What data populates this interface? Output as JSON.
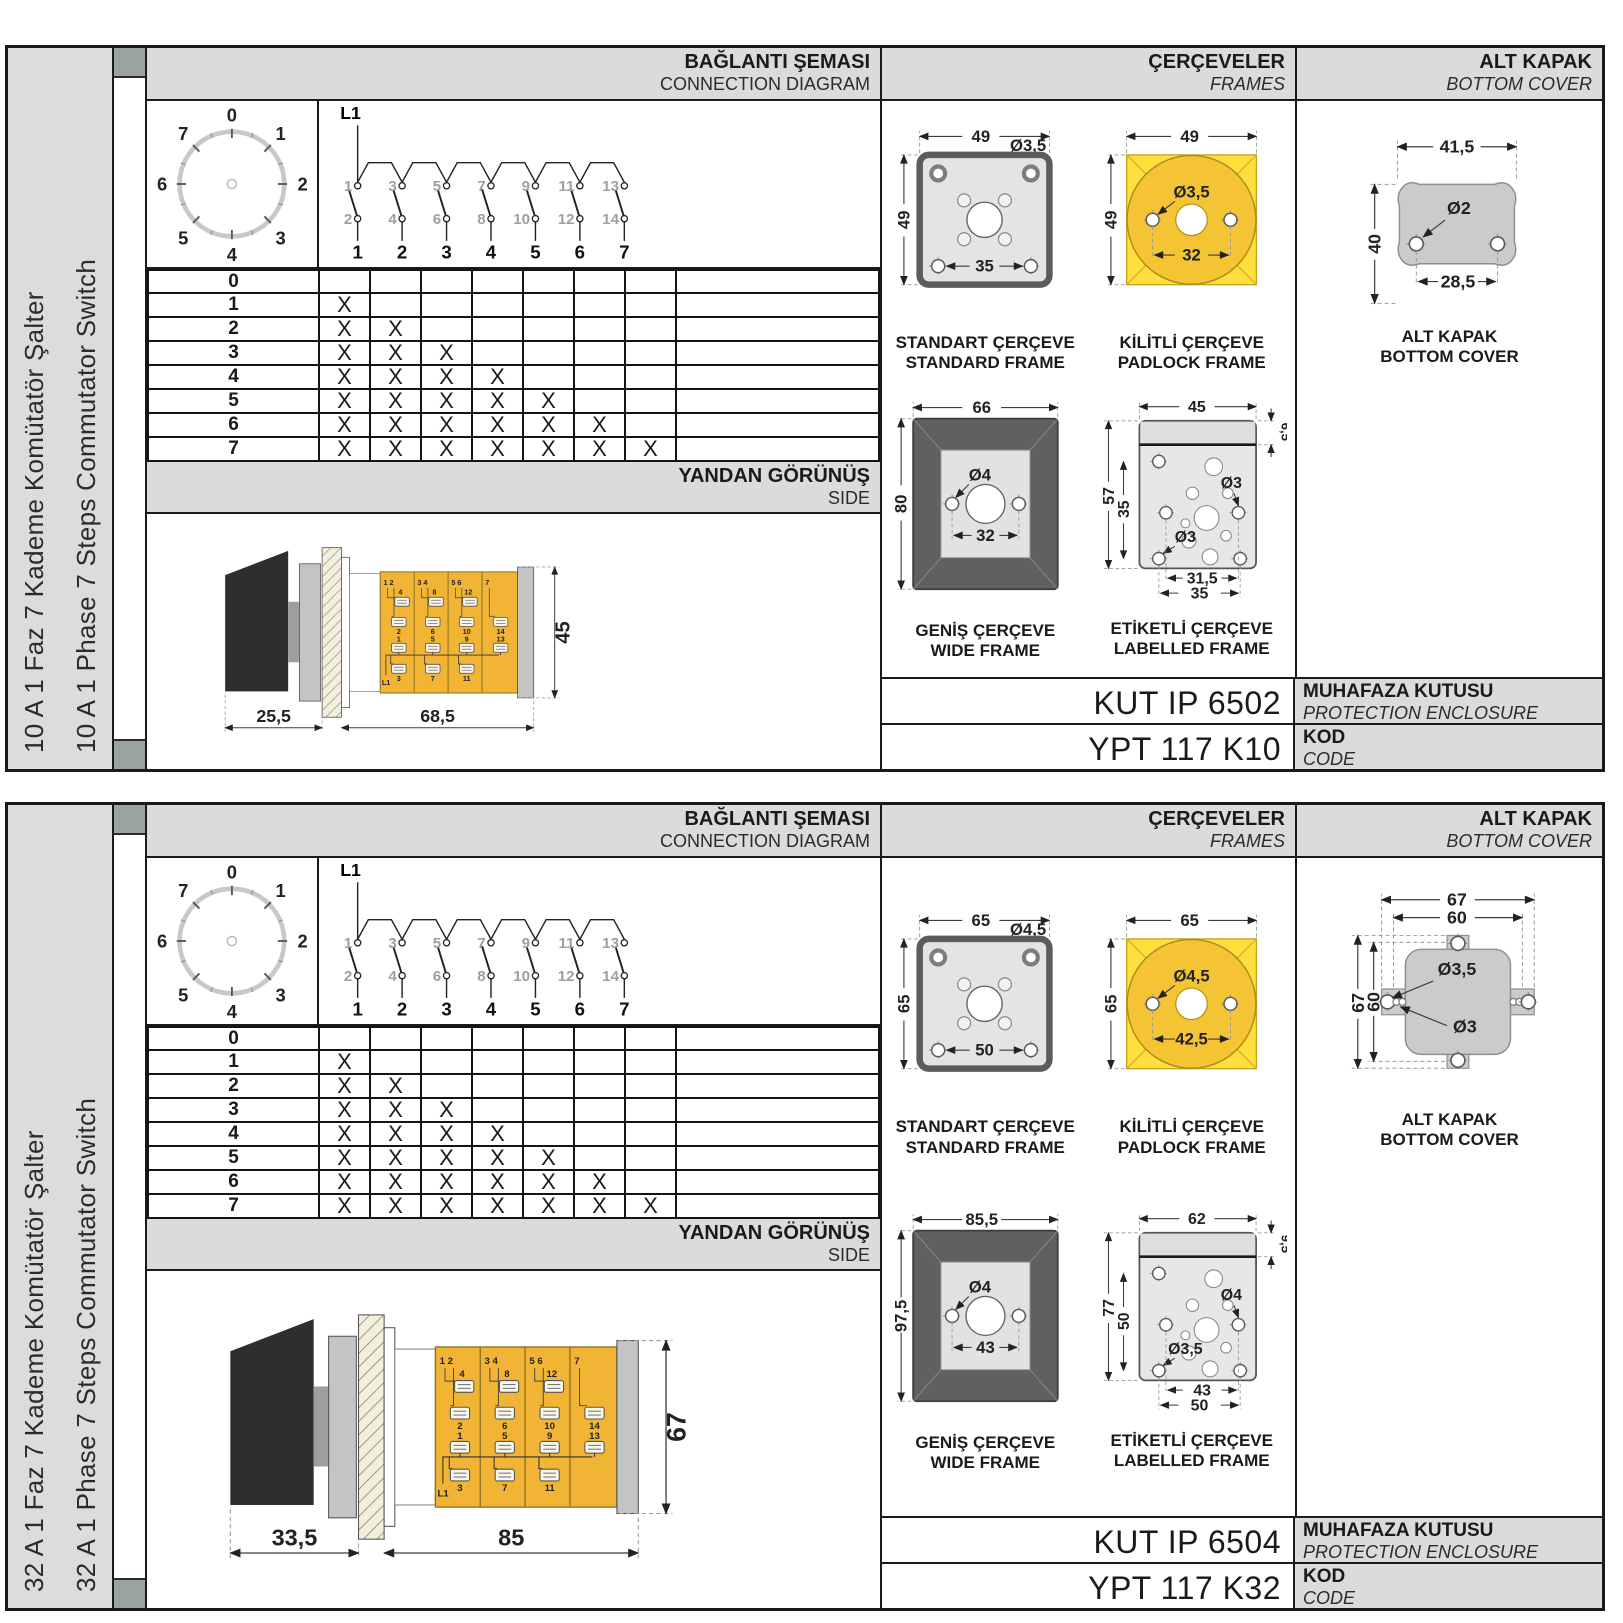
{
  "colors": {
    "body_yellow": "#f1b434",
    "padlock_yellow": "#ffdf3e",
    "padlock_circle": "#f5c434",
    "header_gray": "#dbdbdb",
    "tab_gray": "#9aa49e",
    "frame_dark": "#606060",
    "cover_gray": "#cbcbcb"
  },
  "mark_glyph": "X",
  "sections": [
    {
      "sidebar": {
        "title_tr": "10 A 1 Faz 7 Kademe Komütatör Şalter",
        "title_en": "10 A 1 Phase 7 Steps Commutator Switch"
      },
      "connection": {
        "header_tr": "BAĞLANTI ŞEMASI",
        "header_en": "CONNECTION DIAGRAM",
        "input_label": "L1",
        "dial_positions": [
          "0",
          "1",
          "2",
          "3",
          "4",
          "5",
          "6",
          "7"
        ],
        "contact_top": [
          "1",
          "3",
          "5",
          "7",
          "9",
          "11",
          "13"
        ],
        "contact_bottom": [
          "2",
          "4",
          "6",
          "8",
          "10",
          "12",
          "14"
        ],
        "outputs": [
          "1",
          "2",
          "3",
          "4",
          "5",
          "6",
          "7"
        ],
        "steps": [
          {
            "label": "0",
            "marks": 0
          },
          {
            "label": "1",
            "marks": 1
          },
          {
            "label": "2",
            "marks": 2
          },
          {
            "label": "3",
            "marks": 3
          },
          {
            "label": "4",
            "marks": 4
          },
          {
            "label": "5",
            "marks": 5
          },
          {
            "label": "6",
            "marks": 6
          },
          {
            "label": "7",
            "marks": 7
          }
        ]
      },
      "side_view": {
        "header_tr": "YANDAN GÖRÜNÜŞ",
        "header_en": "SIDE",
        "dim_front": "25,5",
        "dim_length": "68,5",
        "dim_height": "45",
        "input_label": "L1",
        "segment_top_labels": [
          "1 2",
          "3 4",
          "5 6",
          "7"
        ],
        "upper_clip_top": [
          "4",
          "8",
          "12"
        ],
        "upper_clip_bottom": [
          "2",
          "6",
          "10",
          "14"
        ],
        "lower_clip_top": [
          "1",
          "5",
          "9",
          "13"
        ],
        "lower_clip_bottom": [
          "3",
          "7",
          "11"
        ]
      },
      "frames": {
        "header_tr": "ÇERÇEVELER",
        "header_en": "FRAMES",
        "standard": {
          "caption_tr": "STANDART ÇERÇEVE",
          "caption_en": "STANDARD FRAME",
          "width": "49",
          "height": "49",
          "hole": "Ø3,5",
          "pitch": "35"
        },
        "padlock": {
          "caption_tr": "KİLİTLİ ÇERÇEVE",
          "caption_en": "PADLOCK FRAME",
          "width": "49",
          "height": "49",
          "hole": "Ø3,5",
          "pitch": "32"
        },
        "wide": {
          "caption_tr": "GENİŞ ÇERÇEVE",
          "caption_en": "WIDE FRAME",
          "width": "66",
          "height": "80",
          "hole": "Ø4",
          "pitch": "32"
        },
        "labelled": {
          "caption_tr": "ETİKETLİ ÇERÇEVE",
          "caption_en": "LABELLED FRAME",
          "width": "45",
          "tab_height": "6,5",
          "height": "57",
          "hole_span": "35",
          "hole_left": "Ø3",
          "hole_right": "Ø3",
          "pitch_inner": "31,5",
          "pitch_outer": "35"
        }
      },
      "cover": {
        "header_tr": "ALT KAPAK",
        "header_en": "BOTTOM COVER",
        "caption_tr": "ALT KAPAK",
        "caption_en": "BOTTOM COVER",
        "is_plain": true,
        "is_tabs": false,
        "width": "41,5",
        "height": "40",
        "hole": "Ø2",
        "pitch": "28,5"
      },
      "codes": {
        "enclosure_code": "KUT IP 6502",
        "enclosure_label_tr": "MUHAFAZA KUTUSU",
        "enclosure_label_en": "PROTECTION ENCLOSURE",
        "product_code": "YPT 117 K10",
        "code_label_tr": "KOD",
        "code_label_en": "CODE"
      }
    },
    {
      "sidebar": {
        "title_tr": "32 A 1 Faz 7 Kademe Komütatör Şalter",
        "title_en": "32 A 1 Phase 7 Steps Commutator Switch"
      },
      "connection": {
        "header_tr": "BAĞLANTI ŞEMASI",
        "header_en": "CONNECTION DIAGRAM",
        "input_label": "L1",
        "dial_positions": [
          "0",
          "1",
          "2",
          "3",
          "4",
          "5",
          "6",
          "7"
        ],
        "contact_top": [
          "1",
          "3",
          "5",
          "7",
          "9",
          "11",
          "13"
        ],
        "contact_bottom": [
          "2",
          "4",
          "6",
          "8",
          "10",
          "12",
          "14"
        ],
        "outputs": [
          "1",
          "2",
          "3",
          "4",
          "5",
          "6",
          "7"
        ],
        "steps": [
          {
            "label": "0",
            "marks": 0
          },
          {
            "label": "1",
            "marks": 1
          },
          {
            "label": "2",
            "marks": 2
          },
          {
            "label": "3",
            "marks": 3
          },
          {
            "label": "4",
            "marks": 4
          },
          {
            "label": "5",
            "marks": 5
          },
          {
            "label": "6",
            "marks": 6
          },
          {
            "label": "7",
            "marks": 7
          }
        ]
      },
      "side_view": {
        "header_tr": "YANDAN GÖRÜNÜŞ",
        "header_en": "SIDE",
        "dim_front": "33,5",
        "dim_length": "85",
        "dim_height": "67",
        "input_label": "L1",
        "segment_top_labels": [
          "1 2",
          "3 4",
          "5 6",
          "7"
        ],
        "upper_clip_top": [
          "4",
          "8",
          "12"
        ],
        "upper_clip_bottom": [
          "2",
          "6",
          "10",
          "14"
        ],
        "lower_clip_top": [
          "1",
          "5",
          "9",
          "13"
        ],
        "lower_clip_bottom": [
          "3",
          "7",
          "11"
        ]
      },
      "frames": {
        "header_tr": "ÇERÇEVELER",
        "header_en": "FRAMES",
        "standard": {
          "caption_tr": "STANDART ÇERÇEVE",
          "caption_en": "STANDARD FRAME",
          "width": "65",
          "height": "65",
          "hole": "Ø4,5",
          "pitch": "50"
        },
        "padlock": {
          "caption_tr": "KİLİTLİ ÇERÇEVE",
          "caption_en": "PADLOCK FRAME",
          "width": "65",
          "height": "65",
          "hole": "Ø4,5",
          "pitch": "42,5"
        },
        "wide": {
          "caption_tr": "GENİŞ ÇERÇEVE",
          "caption_en": "WIDE FRAME",
          "width": "85,5",
          "height": "97,5",
          "hole": "Ø4",
          "pitch": "43"
        },
        "labelled": {
          "caption_tr": "ETİKETLİ ÇERÇEVE",
          "caption_en": "LABELLED FRAME",
          "width": "62",
          "tab_height": "9,5",
          "height": "77",
          "hole_span": "50",
          "hole_left": "Ø3,5",
          "hole_right": "Ø4",
          "pitch_inner": "43",
          "pitch_outer": "50"
        }
      },
      "cover": {
        "header_tr": "ALT KAPAK",
        "header_en": "BOTTOM COVER",
        "caption_tr": "ALT KAPAK",
        "caption_en": "BOTTOM COVER",
        "is_plain": false,
        "is_tabs": true,
        "width_outer": "67",
        "width_inner": "60",
        "height_outer": "67",
        "height_inner": "60",
        "hole_big": "Ø3,5",
        "hole_small": "Ø3"
      },
      "codes": {
        "enclosure_code": "KUT IP 6504",
        "enclosure_label_tr": "MUHAFAZA KUTUSU",
        "enclosure_label_en": "PROTECTION ENCLOSURE",
        "product_code": "YPT 117 K32",
        "code_label_tr": "KOD",
        "code_label_en": "CODE"
      }
    }
  ]
}
